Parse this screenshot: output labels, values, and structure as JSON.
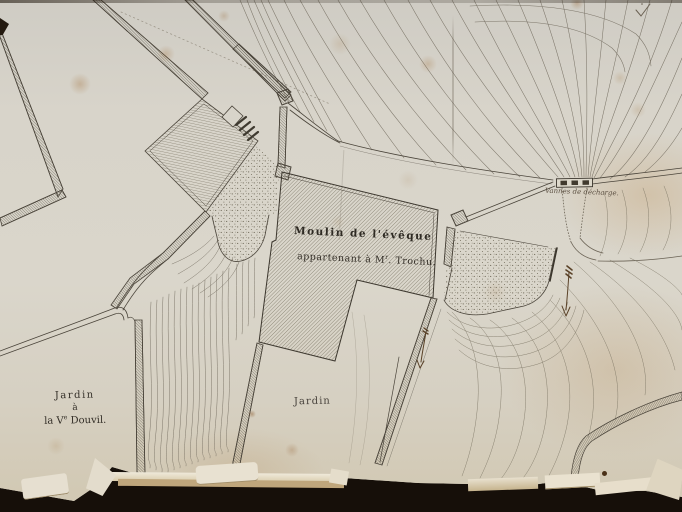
{
  "document": {
    "kind": "photographed manuscript plan",
    "labels": {
      "mill_line1": "Moulin de l'évêque",
      "mill_line2_pre": "appartenant à M",
      "mill_line2_sup": "r",
      "mill_line2_post": ". Trochu.",
      "garden_center": "Jardin",
      "garden_left_line1": "Jardin",
      "garden_left_line2": "à",
      "garden_left_line3_pre": "la V",
      "garden_left_line3_sup": "e",
      "garden_left_line3_post": " Douvil.",
      "sluice": "Vannes de décharge."
    },
    "palette": {
      "paper": "#d8d4ca",
      "ink_lines": "#4a443a",
      "ink_text": "#2e2a23",
      "photo_background": "#160f09",
      "stains": "#b18a5c"
    }
  }
}
